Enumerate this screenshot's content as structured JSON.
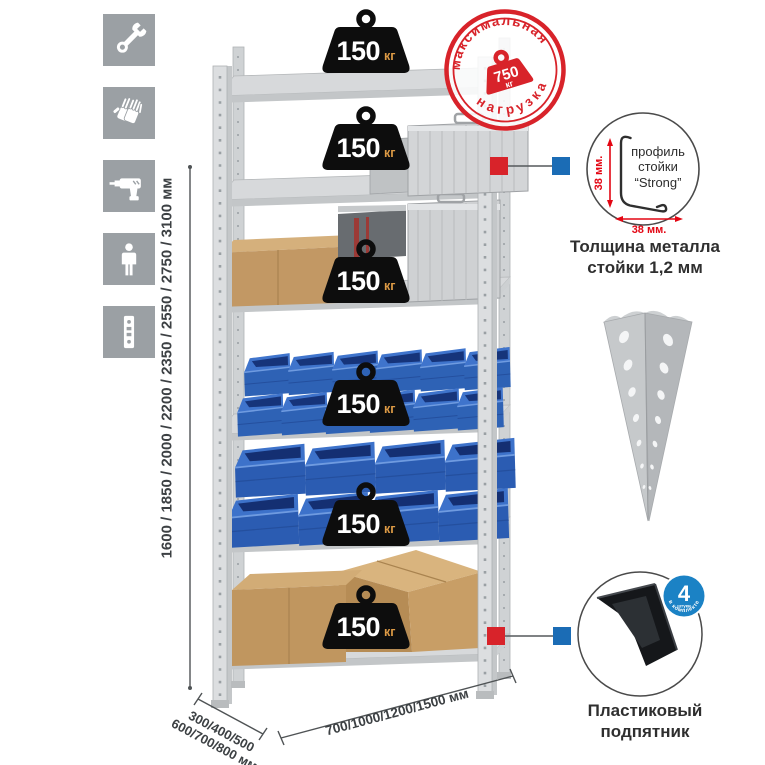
{
  "left_rail": {
    "icons": [
      {
        "name": "wrench-icon"
      },
      {
        "name": "gloves-icon"
      },
      {
        "name": "drill-icon"
      },
      {
        "name": "person-icon"
      },
      {
        "name": "upright-profile-icon"
      }
    ]
  },
  "rack_weights": {
    "value": "150",
    "unit": "кг"
  },
  "stamp": {
    "arc_top": "максимальная",
    "arc_bottom": "нагрузка",
    "value": "750",
    "unit": "кг"
  },
  "dimensions": {
    "height": "1600 / 1850 / 2000 / 2200 / 2350 / 2550 / 2750 / 3100 мм",
    "depth_line1": "300/400/500",
    "depth_line2": "600/700/800 мм",
    "width": "700/1000/1200/1500 мм"
  },
  "profile": {
    "line1": "профиль",
    "line2": "стойки",
    "line3": "“Strong”",
    "dim_v": "38 мм.",
    "dim_h": "38 мм.",
    "caption1": "Толщина металла",
    "caption2": "стойки 1,2 мм"
  },
  "foot": {
    "count": "4",
    "unit": "штуки",
    "arc": "в комплекте",
    "caption1": "Пластиковый",
    "caption2": "подпятник"
  },
  "colors": {
    "accent_red": "#d8232a",
    "accent_blue": "#1b6cb5",
    "weight_black": "#0d0d0d",
    "kg_orange": "#dd9a45",
    "bin_blue": "#2e62b5",
    "metal_gray": "#d8dadc",
    "icon_gray": "#9ba0a4",
    "dim_red": "#e30613"
  }
}
